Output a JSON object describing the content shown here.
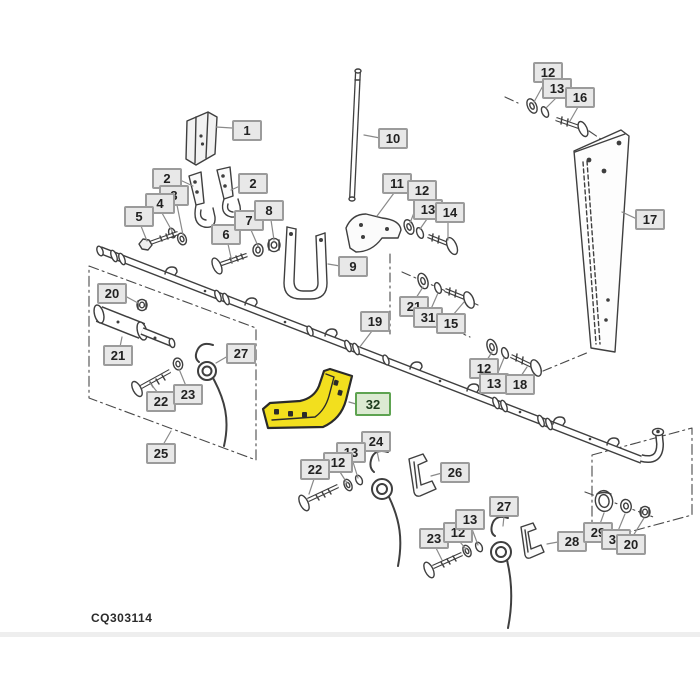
{
  "diagram": {
    "code": "CQ303114",
    "highlighted_part": "32",
    "colors": {
      "line": "#3f3f3f",
      "leader": "#8a8a8a",
      "label_bg": "#e8e8e8",
      "label_border": "#9b9b9b",
      "highlight_fill": "#f2df1e",
      "highlight_label_bg": "#dcead2",
      "highlight_label_border": "#5ea351"
    }
  },
  "callouts": [
    {
      "text": "1"
    },
    {
      "text": "2"
    },
    {
      "text": "2"
    },
    {
      "text": "3"
    },
    {
      "text": "4"
    },
    {
      "text": "5"
    },
    {
      "text": "6"
    },
    {
      "text": "7"
    },
    {
      "text": "8"
    },
    {
      "text": "12"
    },
    {
      "text": "13"
    },
    {
      "text": "16"
    },
    {
      "text": "10"
    },
    {
      "text": "11"
    },
    {
      "text": "12"
    },
    {
      "text": "13"
    },
    {
      "text": "14"
    },
    {
      "text": "17"
    },
    {
      "text": "9"
    },
    {
      "text": "20"
    },
    {
      "text": "21"
    },
    {
      "text": "31"
    },
    {
      "text": "15"
    },
    {
      "text": "19"
    },
    {
      "text": "21"
    },
    {
      "text": "27"
    },
    {
      "text": "12"
    },
    {
      "text": "13"
    },
    {
      "text": "18"
    },
    {
      "text": "22"
    },
    {
      "text": "23"
    },
    {
      "text": "32"
    },
    {
      "text": "25"
    },
    {
      "text": "24"
    },
    {
      "text": "13"
    },
    {
      "text": "12"
    },
    {
      "text": "22"
    },
    {
      "text": "26"
    },
    {
      "text": "23"
    },
    {
      "text": "12"
    },
    {
      "text": "13"
    },
    {
      "text": "27"
    },
    {
      "text": "28"
    },
    {
      "text": "29"
    },
    {
      "text": "30"
    },
    {
      "text": "20"
    }
  ]
}
